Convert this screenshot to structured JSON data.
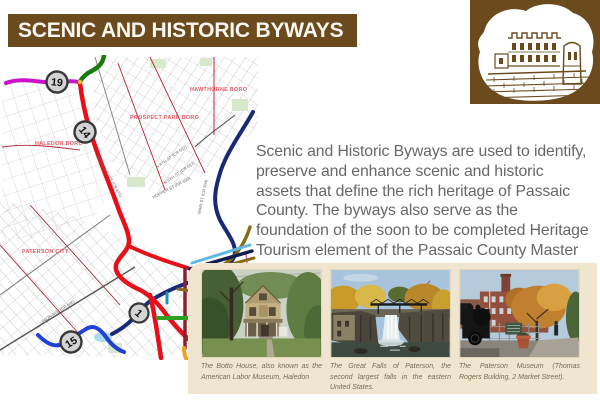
{
  "header": {
    "title": "SCENIC AND HISTORIC BYWAYS"
  },
  "castle": {
    "description": "lambert-castle-duotone-illustration"
  },
  "intro": {
    "text": "Scenic and Historic Byways are used to identify, preserve and enhance scenic and historic assets that define the rich heritage of Passaic County. The byways also serve as the foundation of the soon to be completed Heritage Tourism element of the Passaic County Master Plan."
  },
  "map": {
    "municipalities": {
      "haledon": "HALEDON BORO",
      "prospect_park": "PROSPECT PARK BORO",
      "hawthorne": "HAWTHORNE BORO",
      "paterson": "PATERSON CITY"
    },
    "streets": {
      "belmont": "BELMONT AVE (CR 675)",
      "n8th": "N 8TH ST (CR 657)",
      "n6th": "N 6TH ST (CR 653)",
      "hopper": "HOPPER ST (CR 650)",
      "main": "MAIN ST (CR 504)",
      "union": "UNION AVE (CR 646)"
    },
    "markers": {
      "m19": "19",
      "m14": "14",
      "m15": "15",
      "m1": "1"
    }
  },
  "gallery": {
    "photos": [
      {
        "caption": "The Botto House, also known as the American Labor Museum, Haledon"
      },
      {
        "caption": "The Great Falls of Paterson, the second largest falls in the eastern United States."
      },
      {
        "caption": "The Paterson Museum (Thomas Rogers Building, 2 Market Street)."
      }
    ]
  },
  "colors": {
    "header_bg": "#6b4a1e",
    "panel_bg": "#f0e5cf",
    "byway_red": "#e81018",
    "byway_magenta": "#cc10cc",
    "byway_green": "#1a7a0e",
    "byway_navy": "#1a2878",
    "byway_blue": "#2040d8",
    "byway_brown": "#8a6b14",
    "byway_maroon": "#8c2030",
    "byway_orange": "#f0a020"
  }
}
